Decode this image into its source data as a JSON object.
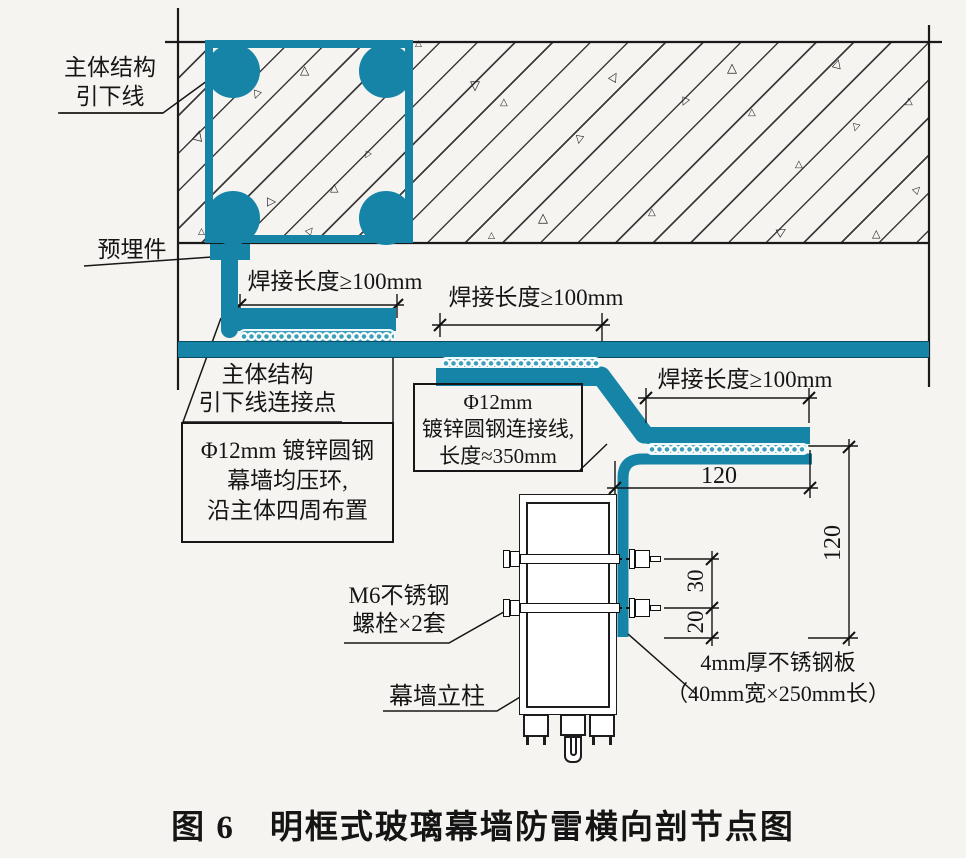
{
  "caption": "图 6　明框式玻璃幕墙防雷横向剖节点图",
  "colors": {
    "steel_teal": "#1584a6",
    "line_black": "#1a1a1a"
  },
  "labels": {
    "down_lead": "主体结构\n引下线",
    "embed_part": "预埋件",
    "weld_length": "焊接长度≥100mm",
    "connection_point": "主体结构\n引下线连接点",
    "ring_note": "Φ12mm 镀锌圆钢\n幕墙均压环,\n沿主体四周布置",
    "wire_note": "Φ12mm\n镀锌圆钢连接线,\n长度≈350mm",
    "bolt_note": "M6不锈钢\n螺栓×2套",
    "mullion": "幕墙立柱",
    "plate_note": "4mm厚不锈钢板\n（40mm宽×250mm长）"
  },
  "dimensions": {
    "plate_width": "120",
    "plate_height": "120",
    "bolt_spacing": "30",
    "bolt_edge": "20"
  },
  "slab": {
    "aggregate_symbol": "△",
    "triangles": [
      [
        193,
        128,
        14,
        15
      ],
      [
        252,
        90,
        11,
        200
      ],
      [
        300,
        64,
        12,
        0
      ],
      [
        268,
        196,
        12,
        90
      ],
      [
        330,
        182,
        11,
        0
      ],
      [
        306,
        226,
        10,
        40
      ],
      [
        364,
        150,
        9,
        210
      ],
      [
        415,
        40,
        9,
        0
      ],
      [
        198,
        228,
        9,
        0
      ],
      [
        470,
        80,
        13,
        180
      ],
      [
        500,
        98,
        10,
        0
      ],
      [
        538,
        212,
        13,
        0
      ],
      [
        575,
        135,
        11,
        190
      ],
      [
        610,
        70,
        12,
        30
      ],
      [
        648,
        208,
        10,
        0
      ],
      [
        680,
        97,
        11,
        205
      ],
      [
        727,
        62,
        13,
        0
      ],
      [
        748,
        108,
        10,
        0
      ],
      [
        778,
        225,
        12,
        60
      ],
      [
        795,
        160,
        10,
        0
      ],
      [
        833,
        57,
        12,
        15
      ],
      [
        852,
        122,
        10,
        195
      ],
      [
        872,
        228,
        11,
        0
      ],
      [
        905,
        97,
        10,
        0
      ],
      [
        913,
        185,
        10,
        45
      ],
      [
        488,
        232,
        9,
        0
      ]
    ]
  }
}
